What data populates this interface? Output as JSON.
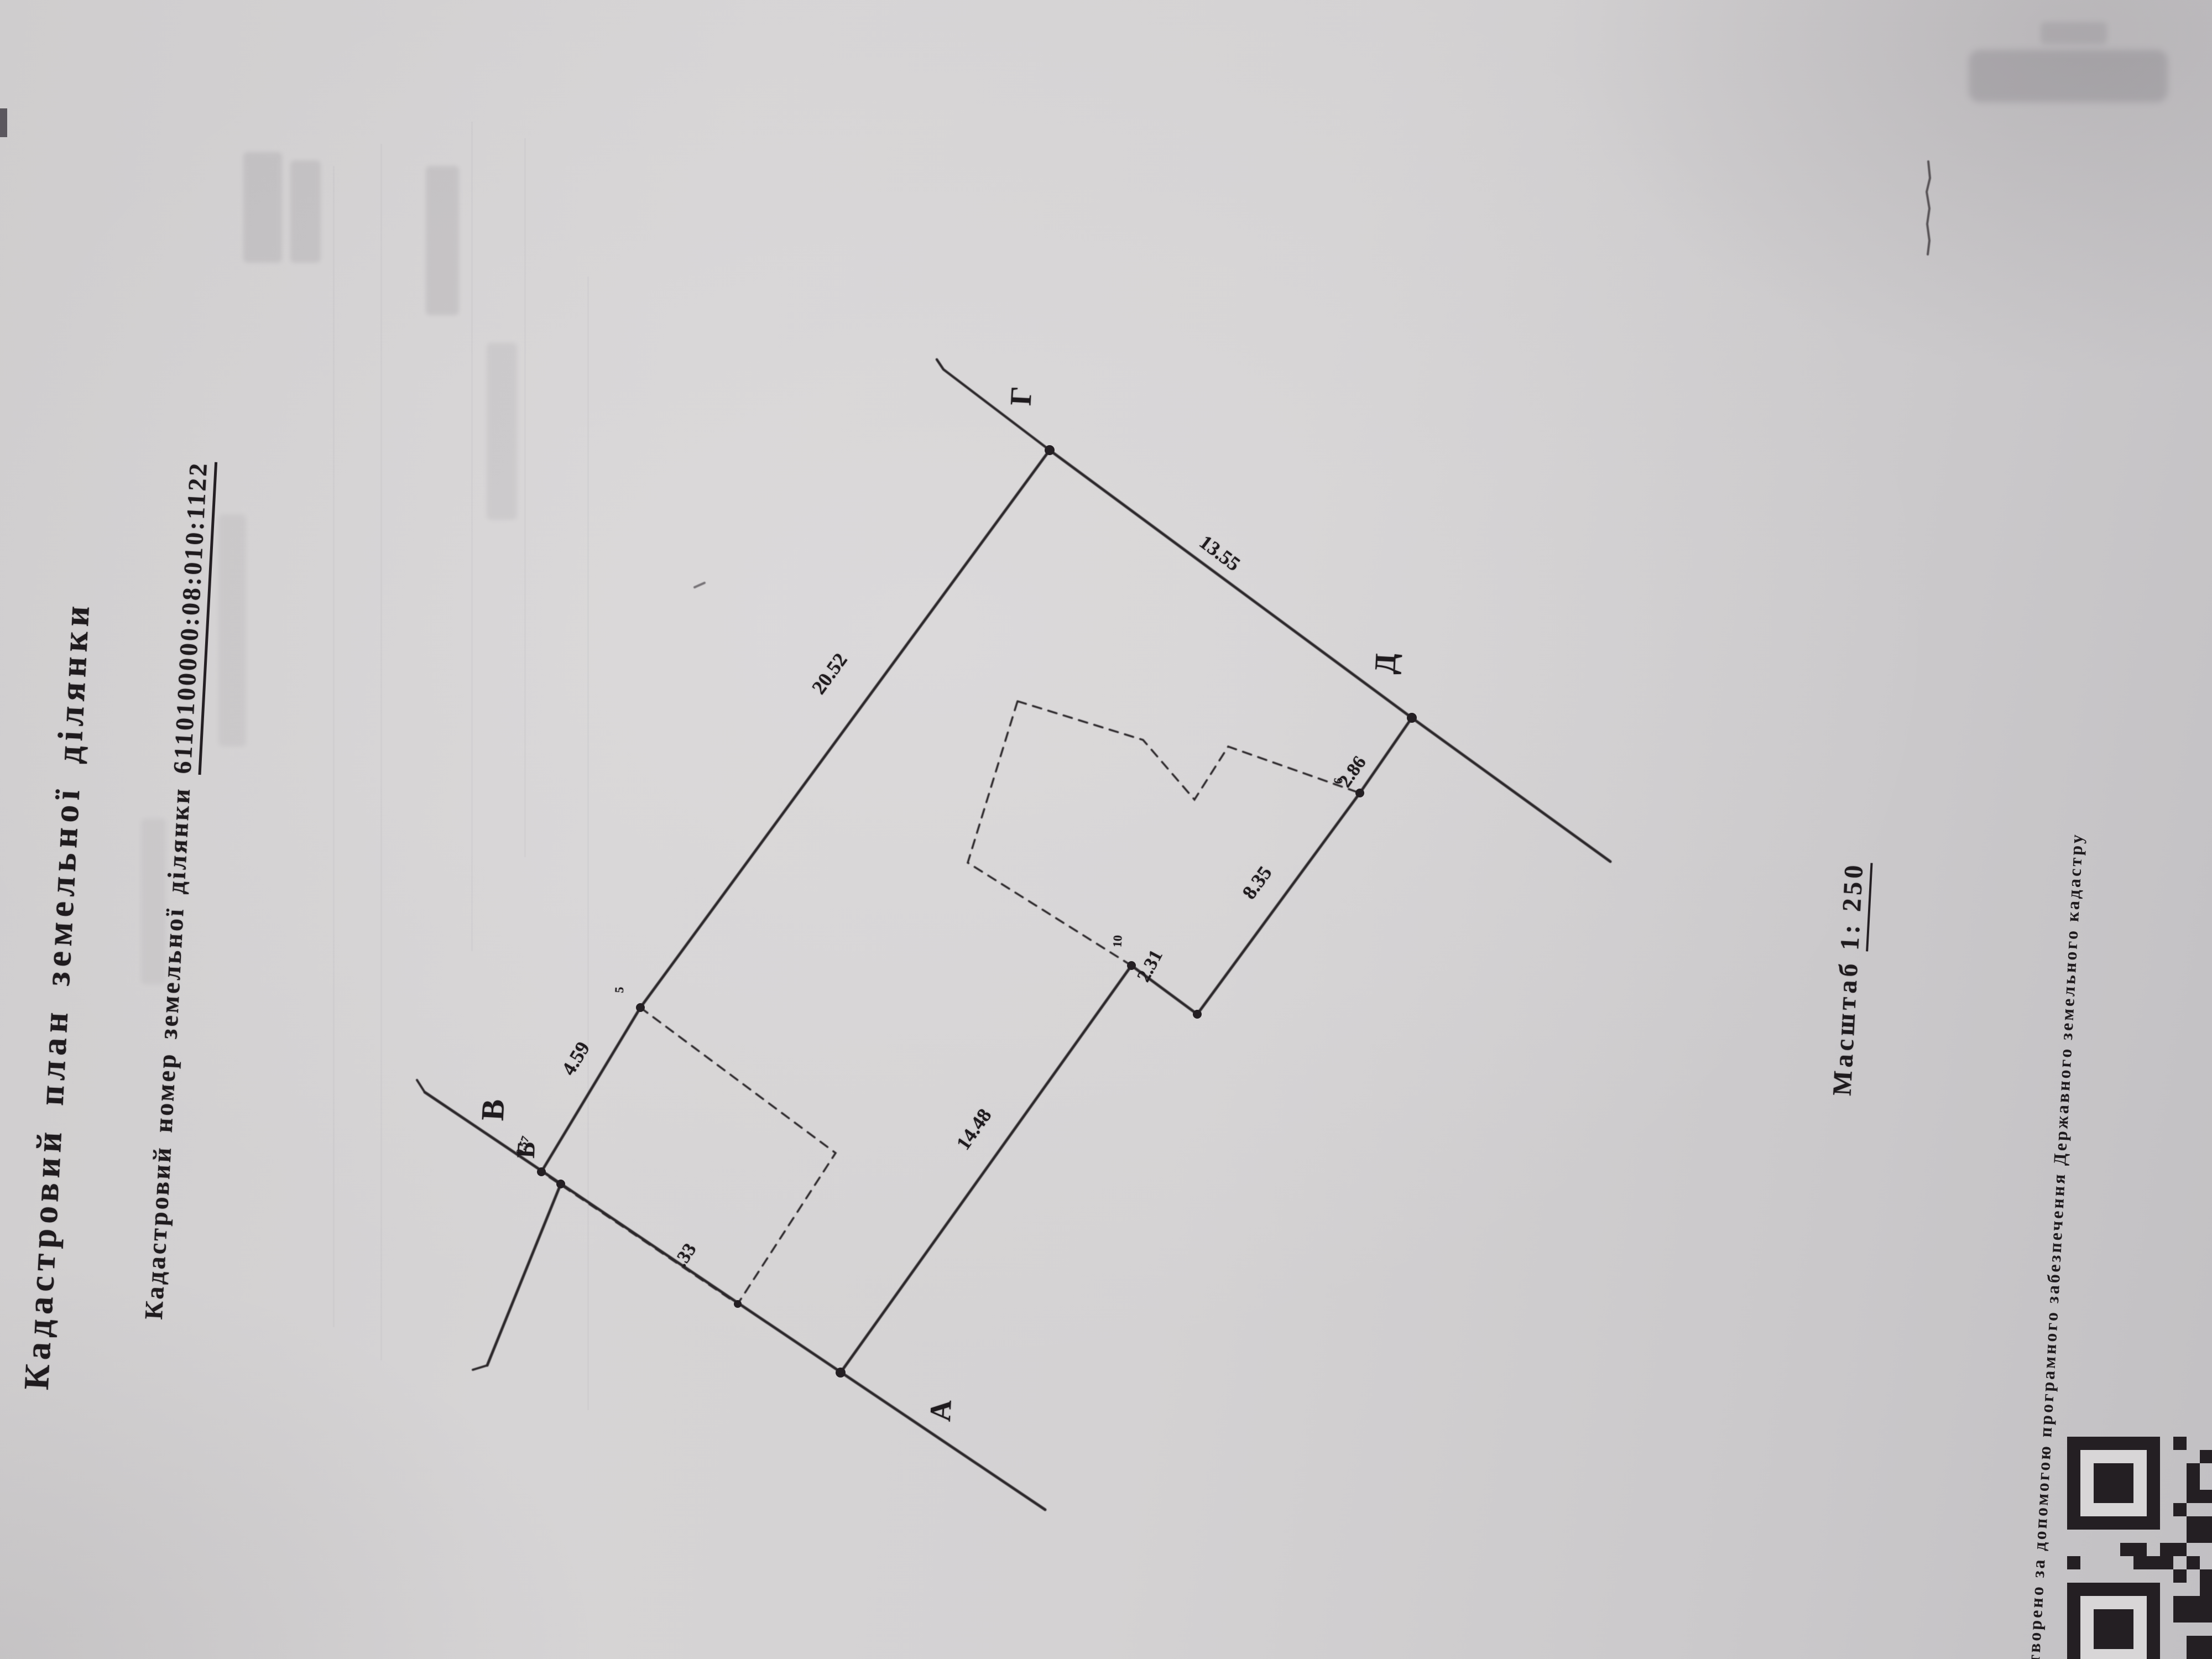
{
  "doc": {
    "title": "Кадастровий план земельної ділянки",
    "number_label": "Кадастровий номер земельної ділянки ",
    "number_value": "6110100000:08:010:1122",
    "scale_label": "Масштаб ",
    "scale_value": "1: 250",
    "margin_note": "Створено за допомогою програмного забезпечення Державного земельного кадастру"
  },
  "plan": {
    "points": {
      "A": "А",
      "B": "Б",
      "V": "В",
      "G": "Г",
      "D": "Д"
    },
    "point_numbers": {
      "n5": "5",
      "n6": "6",
      "n10": "10"
    },
    "dims": {
      "d459": "4.59",
      "d2052": "20.52",
      "d1355": "13.55",
      "d286": "2.86",
      "d835": "8.35",
      "d231": "2.31",
      "d1448": "14.48",
      "d33": ".33",
      "d057": "0.57"
    }
  }
}
